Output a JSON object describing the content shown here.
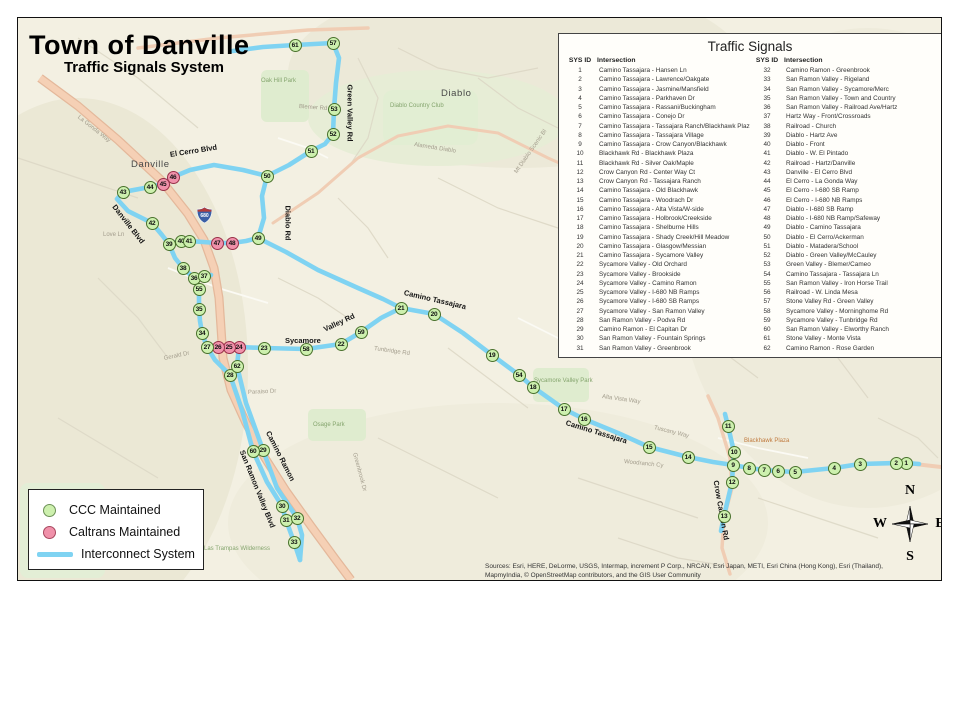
{
  "title": {
    "main": "Town of Danville",
    "subtitle": "Traffic Signals System"
  },
  "signals_panel": {
    "title": "Traffic Signals",
    "header_id": "SYS ID",
    "header_intersection": "Intersection",
    "left": [
      {
        "id": 1,
        "name": "Camino Tassajara - Hansen Ln"
      },
      {
        "id": 2,
        "name": "Camino Tassajara - Lawrence/Oakgate"
      },
      {
        "id": 3,
        "name": "Camino Tassajara - Jasmine/Mansfield"
      },
      {
        "id": 4,
        "name": "Camino Tassajara - Parkhaven Dr"
      },
      {
        "id": 5,
        "name": "Camino Tassajara - Rassani/Buckingham"
      },
      {
        "id": 6,
        "name": "Camino Tassajara - Conejo Dr"
      },
      {
        "id": 7,
        "name": "Camino Tassajara - Tassajara Ranch/Blackhawk Plaza"
      },
      {
        "id": 8,
        "name": "Camino Tassajara - Tassajara Village"
      },
      {
        "id": 9,
        "name": "Camino Tassajara - Crow Canyon/Blackhawk"
      },
      {
        "id": 10,
        "name": "Blackhawk Rd - Blackhawk Plaza"
      },
      {
        "id": 11,
        "name": "Blackhawk Rd - Silver Oak/Maple"
      },
      {
        "id": 12,
        "name": "Crow Canyon Rd - Center Way Ct"
      },
      {
        "id": 13,
        "name": "Crow Canyon Rd - Tassajara Ranch"
      },
      {
        "id": 14,
        "name": "Camino Tassajara - Old Blackhawk"
      },
      {
        "id": 15,
        "name": "Camino Tassajara - Woodrach Dr"
      },
      {
        "id": 16,
        "name": "Camino Tassajara - Alta Vista/W-side"
      },
      {
        "id": 17,
        "name": "Camino Tassajara - Holbrook/Creekside"
      },
      {
        "id": 18,
        "name": "Camino Tassajara - Shelburne Hills"
      },
      {
        "id": 19,
        "name": "Camino Tassajara - Shady Creek/Hill Meadow"
      },
      {
        "id": 20,
        "name": "Camino Tassajara - Glasgow/Messian"
      },
      {
        "id": 21,
        "name": "Camino Tassajara - Sycamore Valley"
      },
      {
        "id": 22,
        "name": "Sycamore Valley - Old Orchard"
      },
      {
        "id": 23,
        "name": "Sycamore Valley - Brookside"
      },
      {
        "id": 24,
        "name": "Sycamore Valley - Camino Ramon"
      },
      {
        "id": 25,
        "name": "Sycamore Valley - I-680 NB Ramps"
      },
      {
        "id": 26,
        "name": "Sycamore Valley - I-680 SB Ramps"
      },
      {
        "id": 27,
        "name": "Sycamore Valley - San Ramon Valley"
      },
      {
        "id": 28,
        "name": "San Ramon Valley - Podva Rd"
      },
      {
        "id": 29,
        "name": "Camino Ramon - El Capitan Dr"
      },
      {
        "id": 30,
        "name": "San Ramon Valley - Fountain Springs"
      },
      {
        "id": 31,
        "name": "San Ramon Valley - Greenbrook"
      }
    ],
    "right": [
      {
        "id": 32,
        "name": "Camino Ramon - Greenbrook"
      },
      {
        "id": 33,
        "name": "San Ramon Valley - Rigeland"
      },
      {
        "id": 34,
        "name": "San Ramon Valley - Sycamore/Merc"
      },
      {
        "id": 35,
        "name": "San Ramon Valley - Town and Country"
      },
      {
        "id": 36,
        "name": "San Ramon Valley - Railroad Ave/Hartz"
      },
      {
        "id": 37,
        "name": "Hartz Way - Front/Crossroads"
      },
      {
        "id": 38,
        "name": "Railroad - Church"
      },
      {
        "id": 39,
        "name": "Diablo - Hartz Ave"
      },
      {
        "id": 40,
        "name": "Diablo - Front"
      },
      {
        "id": 41,
        "name": "Diablo - W. El Pintado"
      },
      {
        "id": 42,
        "name": "Railroad - Hartz/Danville"
      },
      {
        "id": 43,
        "name": "Danville - El Cerro Blvd"
      },
      {
        "id": 44,
        "name": "El Cerro - La Gonda Way"
      },
      {
        "id": 45,
        "name": "El Cerro - I-680 SB Ramp"
      },
      {
        "id": 46,
        "name": "El Cerro - I-680 NB Ramps"
      },
      {
        "id": 47,
        "name": "Diablo - I-680 SB Ramp"
      },
      {
        "id": 48,
        "name": "Diablo - I-680 NB Ramp/Safeway"
      },
      {
        "id": 49,
        "name": "Diablo - Camino Tassajara"
      },
      {
        "id": 50,
        "name": "Diablo - El Cerro/Ackerman"
      },
      {
        "id": 51,
        "name": "Diablo - Matadera/School"
      },
      {
        "id": 52,
        "name": "Diablo - Green Valley/McCauley"
      },
      {
        "id": 53,
        "name": "Green Valley - Blemer/Cameo"
      },
      {
        "id": 54,
        "name": "Camino Tassajara - Tassajara Ln"
      },
      {
        "id": 55,
        "name": "San Ramon Valley - Iron Horse Trail"
      },
      {
        "id": 56,
        "name": "Railroad - W. Linda Mesa"
      },
      {
        "id": 57,
        "name": "Stone Valley Rd - Green Valley"
      },
      {
        "id": 58,
        "name": "Sycamore Valley - Morninghome Rd"
      },
      {
        "id": 59,
        "name": "Sycamore Valley - Tunbridge Rd"
      },
      {
        "id": 60,
        "name": "San Ramon Valley - Elworthy Ranch"
      },
      {
        "id": 61,
        "name": "Stone Valley - Monte Vista"
      },
      {
        "id": 62,
        "name": "Camino Ramon - Rose Garden"
      }
    ]
  },
  "legend": {
    "items": [
      {
        "label": "CCC Maintained",
        "type": "ccc"
      },
      {
        "label": "Caltrans Maintained",
        "type": "caltrans"
      },
      {
        "label": "Interconnect System",
        "type": "line"
      }
    ]
  },
  "compass": {
    "n": "N",
    "s": "S",
    "e": "E",
    "w": "W"
  },
  "sources": {
    "line1": "Sources: Esri, HERE, DeLorme, USGS, Intermap, increment P Corp., NRCAN, Esri Japan, METI, Esri China (Hong Kong), Esri (Thailand),",
    "line2": "MapmyIndia, © OpenStreetMap contributors, and the GIS User Community"
  },
  "map": {
    "shield_label": "680",
    "colors": {
      "interconnect": "#7fd3f2",
      "ccc_marker": "#cdf0ae",
      "caltrans_marker": "#f091aa",
      "freeway": "#f5d0b5",
      "background": "#f3f0e2"
    },
    "markers": [
      {
        "id": 1,
        "x": 888,
        "y": 445,
        "t": "c"
      },
      {
        "id": 2,
        "x": 878,
        "y": 445,
        "t": "c"
      },
      {
        "id": 3,
        "x": 842,
        "y": 446,
        "t": "c"
      },
      {
        "id": 4,
        "x": 816,
        "y": 450,
        "t": "c"
      },
      {
        "id": 5,
        "x": 777,
        "y": 454,
        "t": "c"
      },
      {
        "id": 6,
        "x": 760,
        "y": 453,
        "t": "c"
      },
      {
        "id": 7,
        "x": 746,
        "y": 452,
        "t": "c"
      },
      {
        "id": 8,
        "x": 731,
        "y": 450,
        "t": "c"
      },
      {
        "id": 9,
        "x": 715,
        "y": 447,
        "t": "c"
      },
      {
        "id": 10,
        "x": 716,
        "y": 434,
        "t": "c"
      },
      {
        "id": 11,
        "x": 710,
        "y": 408,
        "t": "c"
      },
      {
        "id": 12,
        "x": 714,
        "y": 464,
        "t": "c"
      },
      {
        "id": 13,
        "x": 706,
        "y": 498,
        "t": "c"
      },
      {
        "id": 14,
        "x": 670,
        "y": 439,
        "t": "c"
      },
      {
        "id": 15,
        "x": 631,
        "y": 429,
        "t": "c"
      },
      {
        "id": 16,
        "x": 566,
        "y": 401,
        "t": "c"
      },
      {
        "id": 17,
        "x": 546,
        "y": 391,
        "t": "c"
      },
      {
        "id": 18,
        "x": 515,
        "y": 369,
        "t": "c"
      },
      {
        "id": 19,
        "x": 474,
        "y": 337,
        "t": "c"
      },
      {
        "id": 20,
        "x": 416,
        "y": 296,
        "t": "c"
      },
      {
        "id": 21,
        "x": 383,
        "y": 290,
        "t": "c"
      },
      {
        "id": 22,
        "x": 323,
        "y": 326,
        "t": "c"
      },
      {
        "id": 23,
        "x": 246,
        "y": 330,
        "t": "c"
      },
      {
        "id": 24,
        "x": 221,
        "y": 329,
        "t": "x"
      },
      {
        "id": 25,
        "x": 211,
        "y": 329,
        "t": "x"
      },
      {
        "id": 26,
        "x": 200,
        "y": 329,
        "t": "x"
      },
      {
        "id": 27,
        "x": 189,
        "y": 329,
        "t": "c"
      },
      {
        "id": 28,
        "x": 212,
        "y": 357,
        "t": "c"
      },
      {
        "id": 29,
        "x": 245,
        "y": 432,
        "t": "c"
      },
      {
        "id": 30,
        "x": 264,
        "y": 488,
        "t": "c"
      },
      {
        "id": 31,
        "x": 268,
        "y": 502,
        "t": "c"
      },
      {
        "id": 32,
        "x": 279,
        "y": 500,
        "t": "c"
      },
      {
        "id": 33,
        "x": 276,
        "y": 524,
        "t": "c"
      },
      {
        "id": 34,
        "x": 184,
        "y": 315,
        "t": "c"
      },
      {
        "id": 35,
        "x": 181,
        "y": 291,
        "t": "c"
      },
      {
        "id": 36,
        "x": 176,
        "y": 260,
        "t": "c"
      },
      {
        "id": 37,
        "x": 186,
        "y": 258,
        "t": "c"
      },
      {
        "id": 38,
        "x": 165,
        "y": 250,
        "t": "c"
      },
      {
        "id": 39,
        "x": 151,
        "y": 226,
        "t": "c"
      },
      {
        "id": 40,
        "x": 163,
        "y": 223,
        "t": "c"
      },
      {
        "id": 41,
        "x": 171,
        "y": 223,
        "t": "c"
      },
      {
        "id": 42,
        "x": 134,
        "y": 205,
        "t": "c"
      },
      {
        "id": 43,
        "x": 105,
        "y": 174,
        "t": "c"
      },
      {
        "id": 44,
        "x": 132,
        "y": 169,
        "t": "c"
      },
      {
        "id": 45,
        "x": 145,
        "y": 166,
        "t": "x"
      },
      {
        "id": 46,
        "x": 155,
        "y": 159,
        "t": "x"
      },
      {
        "id": 47,
        "x": 199,
        "y": 225,
        "t": "x"
      },
      {
        "id": 48,
        "x": 214,
        "y": 225,
        "t": "x"
      },
      {
        "id": 49,
        "x": 240,
        "y": 220,
        "t": "c"
      },
      {
        "id": 50,
        "x": 249,
        "y": 158,
        "t": "c"
      },
      {
        "id": 51,
        "x": 293,
        "y": 133,
        "t": "c"
      },
      {
        "id": 52,
        "x": 315,
        "y": 116,
        "t": "c"
      },
      {
        "id": 53,
        "x": 316,
        "y": 91,
        "t": "c"
      },
      {
        "id": 54,
        "x": 501,
        "y": 357,
        "t": "c"
      },
      {
        "id": 55,
        "x": 181,
        "y": 271,
        "t": "c"
      },
      {
        "id": 57,
        "x": 315,
        "y": 25,
        "t": "c"
      },
      {
        "id": 58,
        "x": 288,
        "y": 331,
        "t": "c"
      },
      {
        "id": 59,
        "x": 343,
        "y": 314,
        "t": "c"
      },
      {
        "id": 60,
        "x": 235,
        "y": 433,
        "t": "c"
      },
      {
        "id": 61,
        "x": 277,
        "y": 27,
        "t": "c"
      },
      {
        "id": 62,
        "x": 219,
        "y": 348,
        "t": "c"
      }
    ],
    "labels": [
      {
        "t": "Danville",
        "x": 113,
        "y": 141,
        "r": 0,
        "k": "town"
      },
      {
        "t": "Diablo",
        "x": 423,
        "y": 70,
        "r": 0,
        "k": "town"
      },
      {
        "t": "El Cerro Blvd",
        "x": 152,
        "y": 132,
        "r": -9,
        "k": "road"
      },
      {
        "t": "Danville Blvd",
        "x": 96,
        "y": 183,
        "r": 52,
        "k": "road"
      },
      {
        "t": "Diablo Rd",
        "x": 270,
        "y": 183,
        "r": 90,
        "k": "road"
      },
      {
        "t": "Green Valley Rd",
        "x": 332,
        "y": 62,
        "r": 90,
        "k": "road"
      },
      {
        "t": "Sycamore",
        "x": 267,
        "y": 318,
        "r": 0,
        "k": "road"
      },
      {
        "t": "Valley Rd",
        "x": 306,
        "y": 307,
        "r": -25,
        "k": "road"
      },
      {
        "t": "Camino Tassajara",
        "x": 386,
        "y": 270,
        "r": 13,
        "k": "road"
      },
      {
        "t": "Camino Tassajara",
        "x": 548,
        "y": 400,
        "r": 17,
        "k": "road"
      },
      {
        "t": "San Ramon Valley Blvd",
        "x": 224,
        "y": 428,
        "r": 68,
        "k": "road"
      },
      {
        "t": "Camino Ramon",
        "x": 250,
        "y": 409,
        "r": 63,
        "k": "road"
      },
      {
        "t": "Crow Canyon Rd",
        "x": 698,
        "y": 458,
        "r": 80,
        "k": "road"
      },
      {
        "t": "La Gonda Way",
        "x": 60,
        "y": 96,
        "r": 38,
        "k": "roadlt"
      },
      {
        "t": "Blemer Rd",
        "x": 281,
        "y": 86,
        "r": 4,
        "k": "roadlt"
      },
      {
        "t": "Alameda Diablo",
        "x": 396,
        "y": 124,
        "r": 9,
        "k": "roadlt"
      },
      {
        "t": "Mt Diablo Scenic Bl",
        "x": 498,
        "y": 152,
        "r": -55,
        "k": "roadlt"
      },
      {
        "t": "Tunbridge Rd",
        "x": 356,
        "y": 328,
        "r": 8,
        "k": "roadlt"
      },
      {
        "t": "Paraiso Dr",
        "x": 230,
        "y": 372,
        "r": -3,
        "k": "roadlt"
      },
      {
        "t": "Alta Vista Way",
        "x": 584,
        "y": 376,
        "r": 8,
        "k": "roadlt"
      },
      {
        "t": "Tuscany Way",
        "x": 636,
        "y": 407,
        "r": 14,
        "k": "roadlt"
      },
      {
        "t": "Woodranch Cy",
        "x": 606,
        "y": 441,
        "r": 6,
        "k": "roadlt"
      },
      {
        "t": "Greenbrook Dr",
        "x": 336,
        "y": 432,
        "r": 75,
        "k": "roadlt"
      },
      {
        "t": "Gerald Dr",
        "x": 146,
        "y": 338,
        "r": -12,
        "k": "roadlt"
      },
      {
        "t": "Love Ln",
        "x": 85,
        "y": 214,
        "r": 0,
        "k": "roadlt"
      },
      {
        "t": "Oak Hill Park",
        "x": 243,
        "y": 60,
        "r": 0,
        "k": "park"
      },
      {
        "t": "Diablo Country Club",
        "x": 372,
        "y": 85,
        "r": 0,
        "k": "park"
      },
      {
        "t": "Osage Park",
        "x": 295,
        "y": 404,
        "r": 0,
        "k": "park"
      },
      {
        "t": "Sycamore Valley Park",
        "x": 516,
        "y": 360,
        "r": 0,
        "k": "park"
      },
      {
        "t": "Las Trampas Wilderness",
        "x": 186,
        "y": 528,
        "r": 0,
        "k": "park"
      },
      {
        "t": "Blackhawk Plaza",
        "x": 726,
        "y": 420,
        "r": 0,
        "k": "poi"
      }
    ]
  }
}
